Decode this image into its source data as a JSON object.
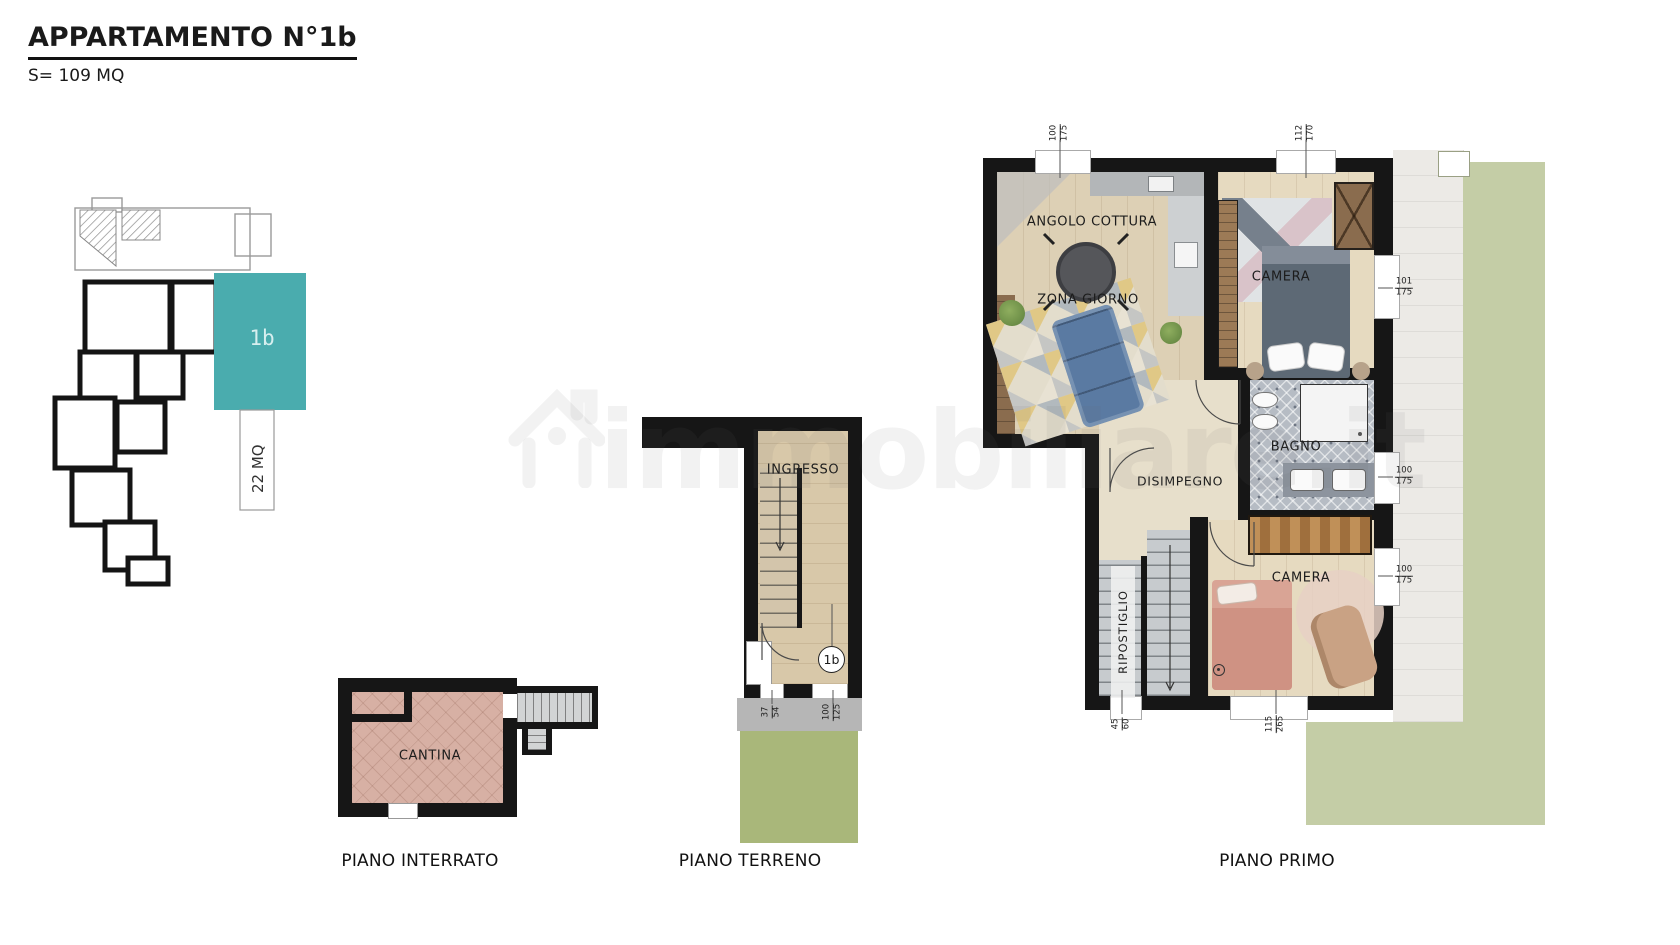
{
  "header": {
    "title": "APPARTAMENTO N°1b",
    "subtitle": "S= 109 MQ"
  },
  "watermark": {
    "text": "immobiliare.it"
  },
  "key_plan": {
    "unit": "1b",
    "area": "22 MQ"
  },
  "colors": {
    "accent_teal": "#4aacae",
    "garden_green": "#c4cda6",
    "grass_green": "#a9b77a",
    "wall_black": "#161616",
    "cantina_floor": "#d7b0a4"
  },
  "floors": {
    "interrato": {
      "caption": "PIANO INTERRATO",
      "rooms": {
        "cantina": "CANTINA"
      }
    },
    "terreno": {
      "caption": "PIANO TERRENO",
      "rooms": {
        "ingresso": "INGRESSO"
      },
      "badge": "1b",
      "dims": {
        "d1": {
          "a": "37",
          "b": "54"
        },
        "d2": {
          "a": "100",
          "b": "125"
        }
      }
    },
    "primo": {
      "caption": "PIANO PRIMO",
      "rooms": {
        "cottura": "ANGOLO COTTURA",
        "giorno": "ZONA GIORNO",
        "camera1": "CAMERA",
        "bagno": "BAGNO",
        "disimpegno": "DISIMPEGNO",
        "ripostiglio": "RIPOSTIGLIO",
        "camera2": "CAMERA"
      },
      "dims": {
        "top1": {
          "a": "100",
          "b": "175"
        },
        "top2": {
          "a": "112",
          "b": "170"
        },
        "right1": {
          "a": "101",
          "b": "175"
        },
        "right2": {
          "a": "100",
          "b": "175"
        },
        "right3": {
          "a": "100",
          "b": "175"
        },
        "bottom_door": {
          "a": "45",
          "b": "60"
        },
        "bottom_win": {
          "a": "115",
          "b": "265"
        }
      }
    }
  }
}
